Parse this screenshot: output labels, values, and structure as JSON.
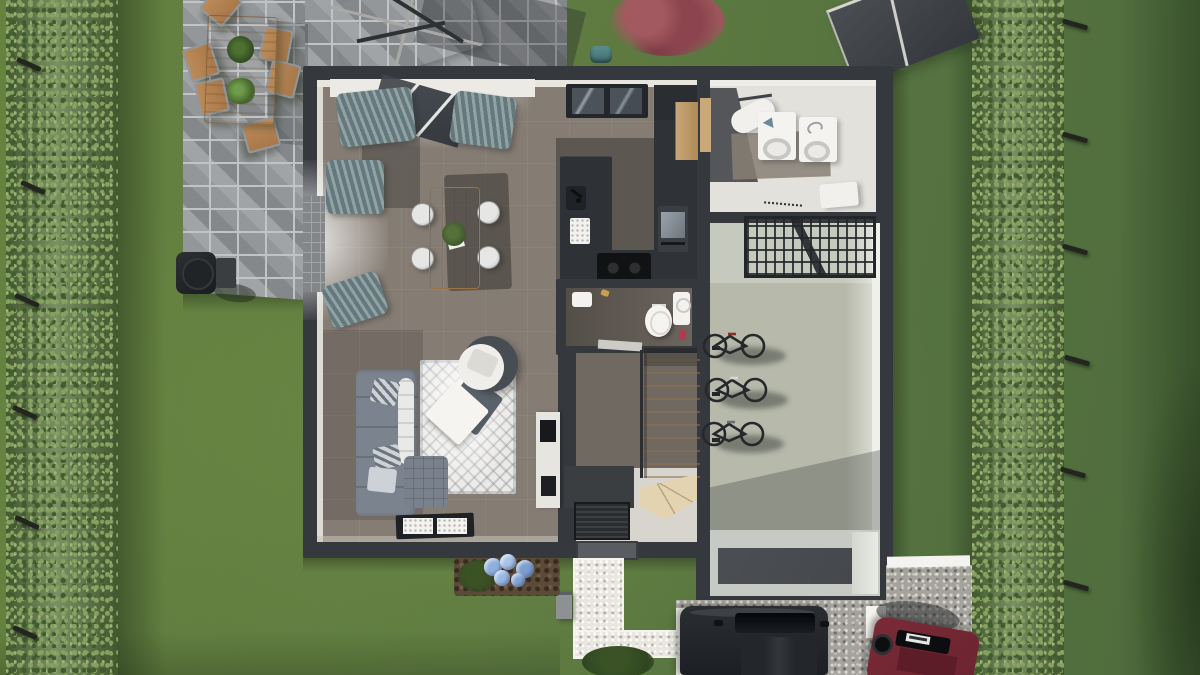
{
  "title": "Top-down 3D rendering of a single-storey house plan with garden, terrace, garage and driveway",
  "colors": {
    "lawn": "#5f7b41",
    "lawnDark": "#49632f",
    "shadowGreen": "#253c1e",
    "hedge": "#5d7742",
    "hedgeLight": "#86a160",
    "hedgeDark": "#405c2e",
    "post": "#23261f",
    "paver": "#94979a",
    "paverJoint": "#c2c3c5",
    "wall": "#35383d",
    "innerWall": "#e8e5df",
    "floorLiving": "#857c73",
    "floorDark": "#5c5751",
    "floorHall": "#d7d5ce",
    "floorBath": "#544e48",
    "floorUtility": "#e2e1dc",
    "utilityDark": "#54565a",
    "floorGarage": "#b7baab",
    "counter": "#2e3135",
    "hob": "#101214",
    "wood": "#c59f6e",
    "woodOutdoor": "#c49464",
    "stairs": "#eee0c0",
    "sofa": "#7b838e",
    "cushion": "#e9e9e7",
    "pouf": "#79818c",
    "rug": "#eceae6",
    "curtainDark": "#63797d",
    "glazing": "#41464c",
    "toilet": "#f5f4f1",
    "appliance": "#f4f3f0",
    "drum": "#c6c6c3",
    "rackMetal": "#232629",
    "bike": "#26282b",
    "recess": "#c6c9c4",
    "recessFloor": "#45484c",
    "gravel": "#a5a29c",
    "path": "#e9e6e0",
    "curb": "#f4f3ef",
    "carDark": "#1c1f23",
    "carGlass": "#0b0d10",
    "carRed": "#6a2430",
    "carRedRoof": "#5c1d29",
    "mulch": "#5b4a38",
    "hydrangeaA": "#8fb0dc",
    "hydrangeaB": "#a9c4e8",
    "hydrangeaC": "#7d9ecf",
    "bushRed": "#97515a",
    "teal": "#5d8e8e",
    "shed": "#43474b",
    "shedEdge": "#d6d5d1",
    "boxGray": "#8d9194"
  },
  "scene": {
    "garden": {
      "ground": "lawn",
      "left_hedge": {
        "posts": 6
      },
      "right_hedge": {
        "posts": 6
      },
      "red_shrub": "burgundy ornamental bush",
      "garden_shed": "dark grey shed (top right)",
      "hose_reel": "small teal object by north wall"
    },
    "terrace": {
      "surface": "grey stone pavers",
      "dining_table": {
        "material": "wood",
        "plants_on_table": 2,
        "chairs": 6
      },
      "parasol": "light grey cantilever parasol",
      "bbq": "black barbecue grill"
    },
    "house": {
      "living_room": {
        "dining_table": {
          "material": "light wood",
          "chairs": 4,
          "centerpiece": "plant"
        },
        "kitchen": {
          "peninsula_counter": "dark grey",
          "hob": "black glass",
          "oven": "wall oven",
          "tall_cabinet": "wood",
          "sink_faucet": "black"
        },
        "sofa": {
          "type": "L-shaped",
          "color": "grey",
          "pillows": 3
        },
        "pouf": "quilted grey",
        "armchair": "round grey with white cushion",
        "rug": "white patterned",
        "throws": [
          "white blanket",
          "grey blanket"
        ],
        "door_mats": 2,
        "windows": {
          "north_bay_curtains": 2,
          "west_window_curtains": 2,
          "north_skylight_panes": 2
        }
      },
      "bathroom": {
        "toilet": 1,
        "washbasin": 1,
        "shelf": 1,
        "red_bottle": 1
      },
      "entrance_hall": {
        "staircase": "wooden with winder",
        "doormat": 1,
        "shelf_unit": "white with black hifi",
        "front_door": "south wall"
      },
      "utility_room": {
        "washer": 1,
        "dryer": 1,
        "ironing_board": 1,
        "laundry_basket": 1
      },
      "garage": {
        "bikes": 3,
        "ceiling_storage_rack": 1,
        "wall_hooks": 3,
        "door_opening": "south"
      }
    },
    "driveway": {
      "surface": "grey gravel",
      "front_path": "white gravel L-shape with kerbs",
      "cars": [
        {
          "color": "black"
        },
        {
          "color": "dark red"
        }
      ],
      "kerbs": "white concrete",
      "utility_box": "grey meter box",
      "flower_bed": {
        "plant": "blue hydrangea",
        "ground": "brown mulch"
      },
      "bush_south": "dark green shrub"
    }
  }
}
